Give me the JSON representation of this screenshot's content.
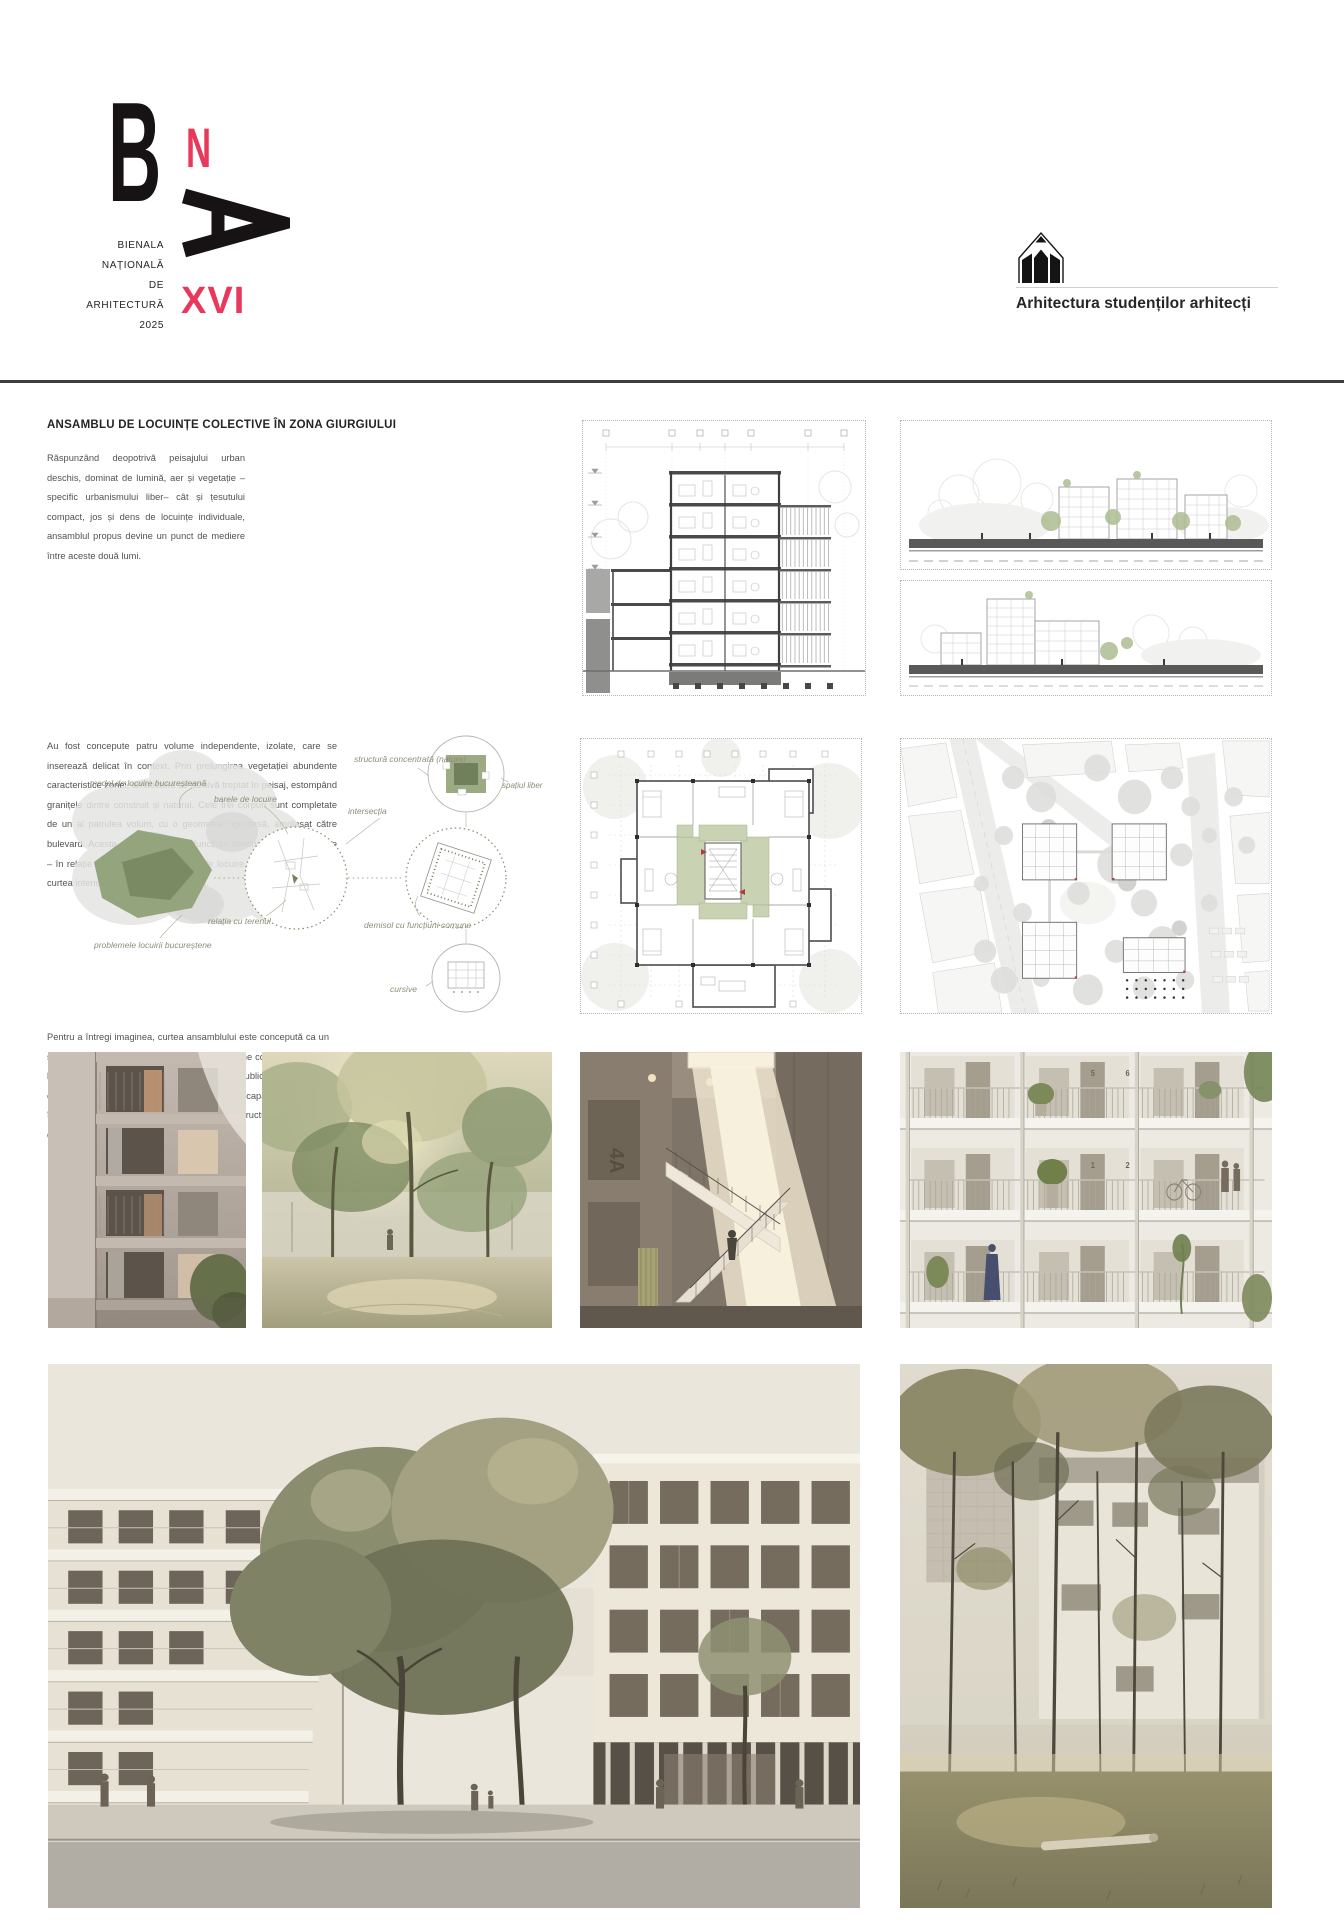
{
  "poster": {
    "logo": {
      "letter_b": "B",
      "letter_n": "N",
      "letter_a": "A",
      "name_lines": [
        "BIENALA",
        "NAȚIONALĂ",
        "DE",
        "ARHITECTURĂ",
        "2025"
      ],
      "edition": "XVI",
      "accent_color": "#e8395c"
    },
    "partner": {
      "label": "Arhitectura studenților arhitecți",
      "icon": "pencil-house-icon"
    },
    "project": {
      "title": "ANSAMBLU DE LOCUINȚE COLECTIVE ÎN ZONA GIURGIULUI",
      "paragraphs": [
        "Răspunzând deopotrivă peisajului urban deschis, dominat de lumină, aer și vegetație – specific urbanismului  liber– cât și țesutului compact, jos și dens de locuințe individuale, ansamblul propus devine un punct de mediere între aceste două lumi.",
        "Au fost concepute patru volume independente, izolate, care se inserează delicat în context. Prin prelungirea vegetației abundente caracteristice zonei, arhitectura se dizolvă treptat în peisaj, estompând granițele dintre construit și natural. Cele trei corpuri sunt completate de un al patrulea volum, cu o geometrie riguroasă, amplasat către bulevard. Acesta adăpostește atât funcțiuni destinate utilizării publice – în relație cu piațeta –, cât și spații de locuire, deschizându-se spre curtea interioară printr-o cursivă amplă.",
        "Pentru a întregi imaginea, curtea ansamblului este concepută ca un spațiu coborât, în jurul căruia se articulează zone comune destinate locatarilor. Între stradă și grădină, între public și privat, se conturează astfel o tipologie urbană nouă, capabilă să aducă împreună două realități contrastante într-o structură coerentă și deschisă."
      ]
    },
    "concept_diagram": {
      "labels": {
        "model": "model de locuire bucureșteană",
        "problems": "problemele locuirii bucureștene",
        "terrain": "relația cu terenul",
        "bars": "barele de locuire",
        "intersection": "intersecția",
        "basement": "demisol cu funcțiuni comune",
        "structure": "structură concentrată (natura)",
        "free_space": "spațiul liber",
        "walkway": "cursive"
      }
    },
    "photos": {
      "stairwell_mark": "4A",
      "apartment_numbers": [
        "5",
        "6",
        "1",
        "2"
      ]
    }
  }
}
